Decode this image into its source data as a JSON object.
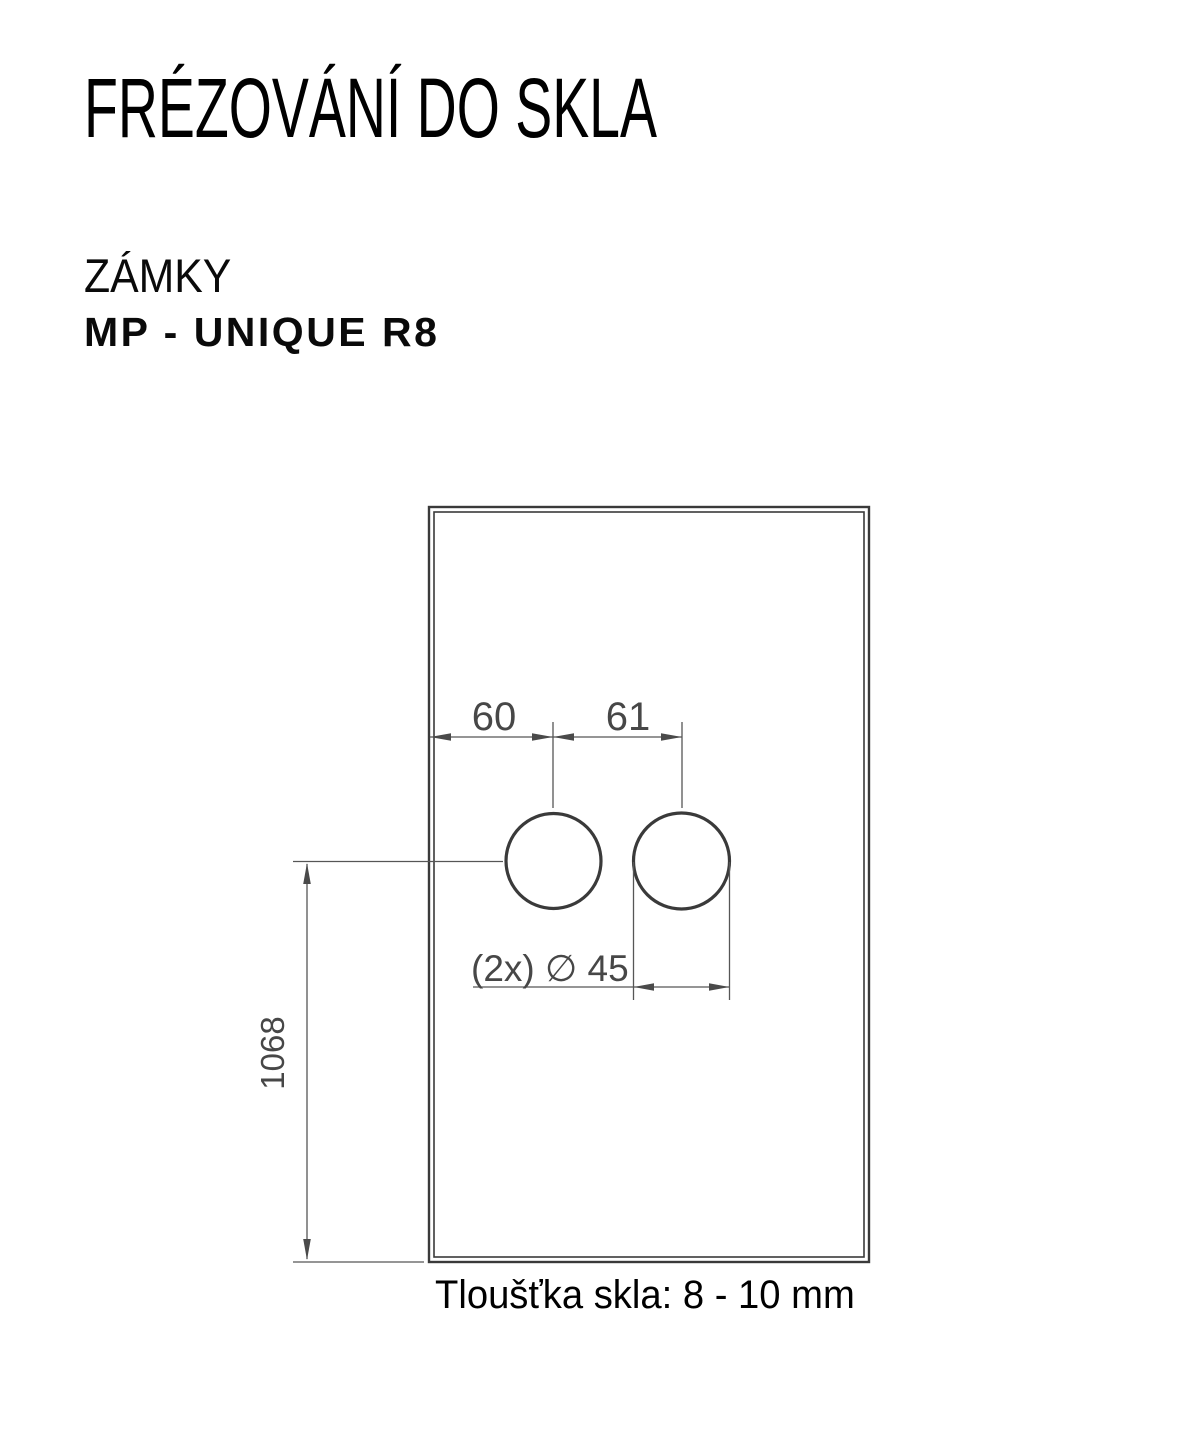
{
  "page": {
    "title": "FRÉZOVÁNÍ DO SKLA",
    "category": "ZÁMKY",
    "product": "MP - UNIQUE R8",
    "caption": "Tloušťka skla: 8 - 10 mm"
  },
  "drawing": {
    "description": "glass-panel-milling-diagram",
    "dims": {
      "edge_to_first_hole": "60",
      "hole_center_distance": "61",
      "hole_diameter": "(2x) ∅ 45",
      "bottom_to_hole_center": "1068"
    },
    "holes_count": 2,
    "colors": {
      "outline": "#3a3a3a",
      "dimension_lines": "#565656",
      "dimension_text": "#474747",
      "heading_text": "#000000"
    }
  }
}
